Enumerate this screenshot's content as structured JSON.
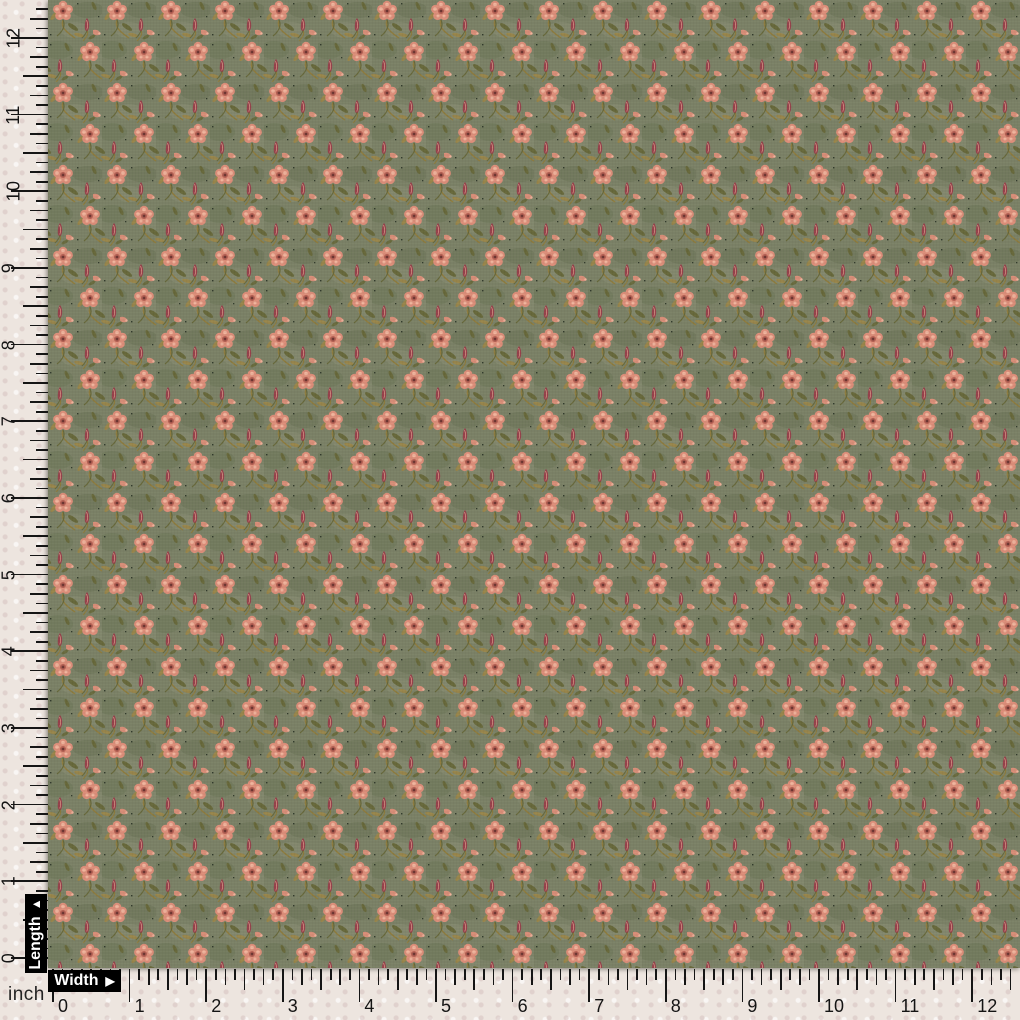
{
  "page": {
    "description": "Olive green floral dress fabric swatch photographed behind inch measurement rulers",
    "unit": "inch"
  },
  "labels": {
    "length": "Length",
    "length_arrow": "▲",
    "width": "Width",
    "width_arrow": "▶",
    "unit": "inch"
  },
  "length_ruler": {
    "orientation": "vertical",
    "numbers": [
      "0",
      "1",
      "2",
      "3",
      "4",
      "5",
      "6",
      "7",
      "8",
      "9",
      "10",
      "11",
      "12"
    ]
  },
  "width_ruler": {
    "orientation": "horizontal",
    "numbers": [
      "0",
      "1",
      "2",
      "3",
      "4",
      "5",
      "6",
      "7",
      "8",
      "9",
      "10",
      "11",
      "12"
    ]
  },
  "colors": {
    "ruler_bg": "#EDE5DF",
    "tick": "#151515",
    "number": "#141414",
    "label_bg": "#000000",
    "label_text": "#FFFFFF",
    "fabric_base": "#7B8166",
    "fabric_shade": "#646E50",
    "fabric_light": "#8E9378",
    "flower_petal": "#DD8E79",
    "flower_light": "#F0B49C",
    "flower_deep": "#B55F52",
    "flower_center": "#6E3632",
    "bud": "#953F49",
    "leaf_olive": "#67683A",
    "leaf_gold": "#98854A",
    "stem_gold": "#8D7B3D",
    "speck_dark": "#2F3829"
  }
}
